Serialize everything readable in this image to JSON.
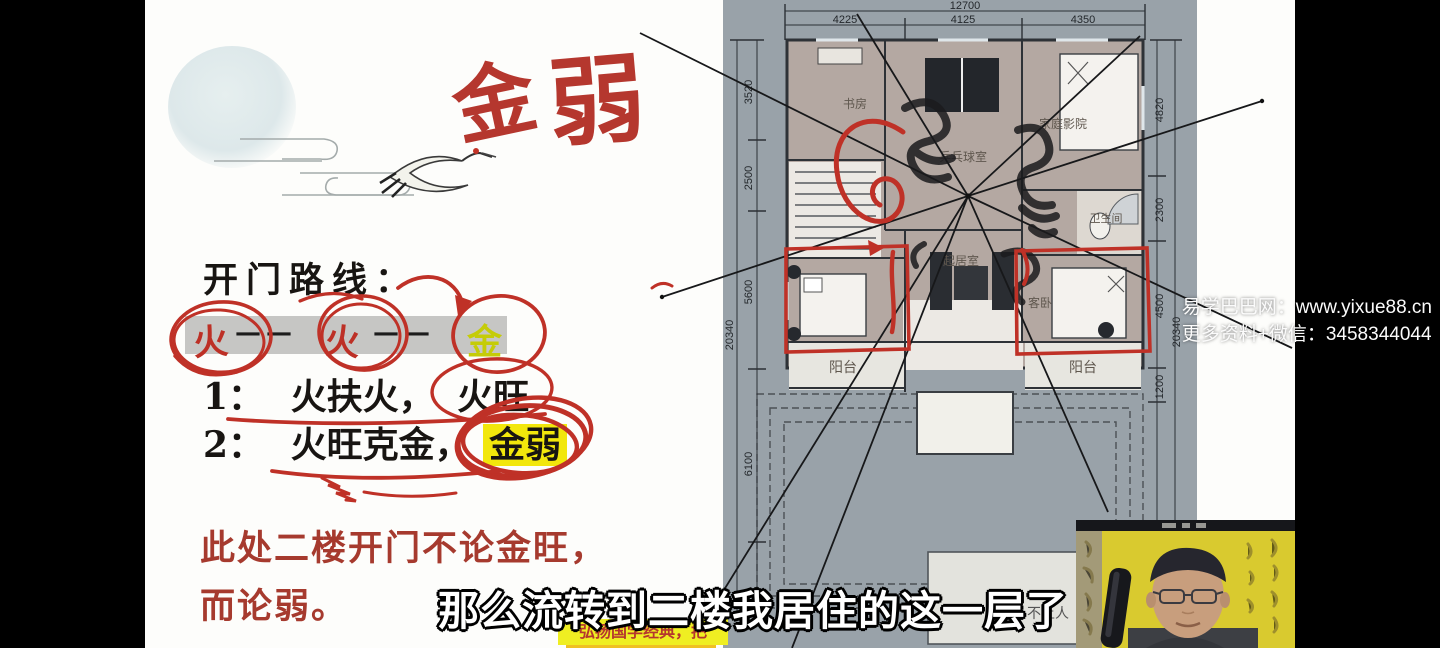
{
  "notes": {
    "handwritten_1": "金",
    "handwritten_2": "弱",
    "heading": "开门路线：",
    "flow": {
      "a": "火",
      "dash1": "— —",
      "b": "火",
      "dash2": "— —",
      "c": "金"
    },
    "line1_no": "1：",
    "line1_a": "火扶火，",
    "line1_b": "火旺",
    "line2_no": "2：",
    "line2_a": "火旺克金，",
    "line2_b": "金弱",
    "red_line1": "此处二楼开门不论金旺，",
    "red_line2": "而论弱。",
    "banner": "弘扬国学经典，把"
  },
  "subtitle": "那么流转到二楼我居住的这一层了",
  "watermark": {
    "line1": "易学巴巴网：www.yixue88.cn",
    "line2": "更多资料+微信：3458344044"
  },
  "plan": {
    "dim_top_total": "12700",
    "dim_top": [
      "4225",
      "4125",
      "4350"
    ],
    "dim_left": [
      "3520",
      "2500",
      "5600",
      "6100"
    ],
    "dim_left_total": "20340",
    "dim_right": [
      "4820",
      "2300",
      "4500",
      "1200"
    ],
    "dim_right_total": "20340",
    "rooms": {
      "study": "书房",
      "pingpong": "乒乓球室",
      "cinema": "家庭影院",
      "bath": "卫生间",
      "living": "起居室",
      "guest": "客卧",
      "balcony_left": "阳台",
      "balcony_right": "阳台",
      "roof": "不上人"
    }
  },
  "colors": {
    "marker_red": "#bf3127",
    "highlight_yellow": "#f2e70c",
    "plan_background": "#99a2a9",
    "room_floor": "#b4a8a2",
    "banner_yellow": "#efee22",
    "gold_text": "#c5cc08"
  }
}
